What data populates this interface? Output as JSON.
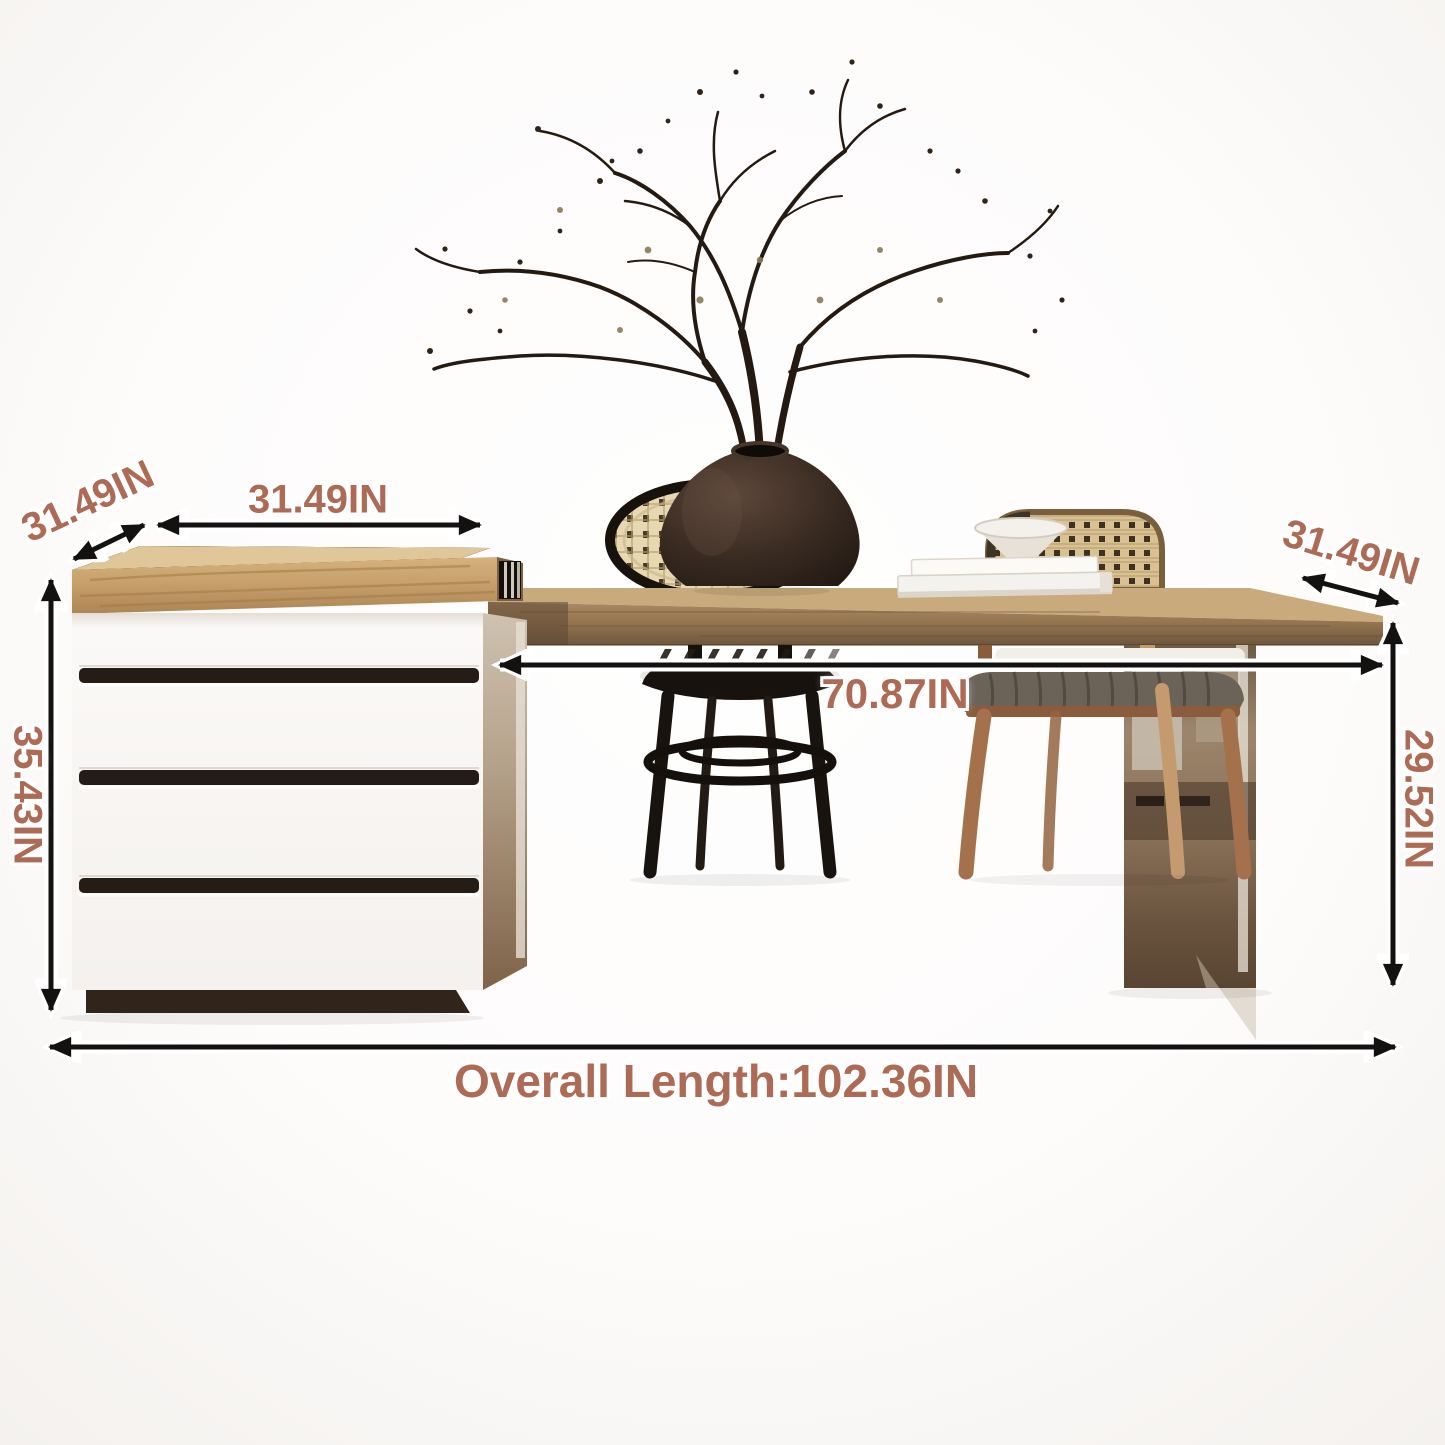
{
  "title": "Dining table with storage cabinet dimension diagram",
  "dimensions": {
    "cabinet_depth_label": "31.49IN",
    "cabinet_width_label": "31.49IN",
    "table_depth_label": "31.49IN",
    "table_length_label": "70.87IN",
    "cabinet_height_label": "35.43IN",
    "table_height_label": "29.52IN",
    "overall_length_label": "Overall Length:102.36IN"
  },
  "palette": {
    "accent": "#ad6b55",
    "arrow": "#161412",
    "cabinet_top_wood": "#c9a36b",
    "table_wood": "#9a7a55",
    "cabinet_white": "#fbf9f7",
    "drawer_groove": "#241c15",
    "plinth": "#33271e",
    "mirror_leg": "#8a735c",
    "vase": "#2c211a",
    "cane": "#e0ceA2"
  }
}
